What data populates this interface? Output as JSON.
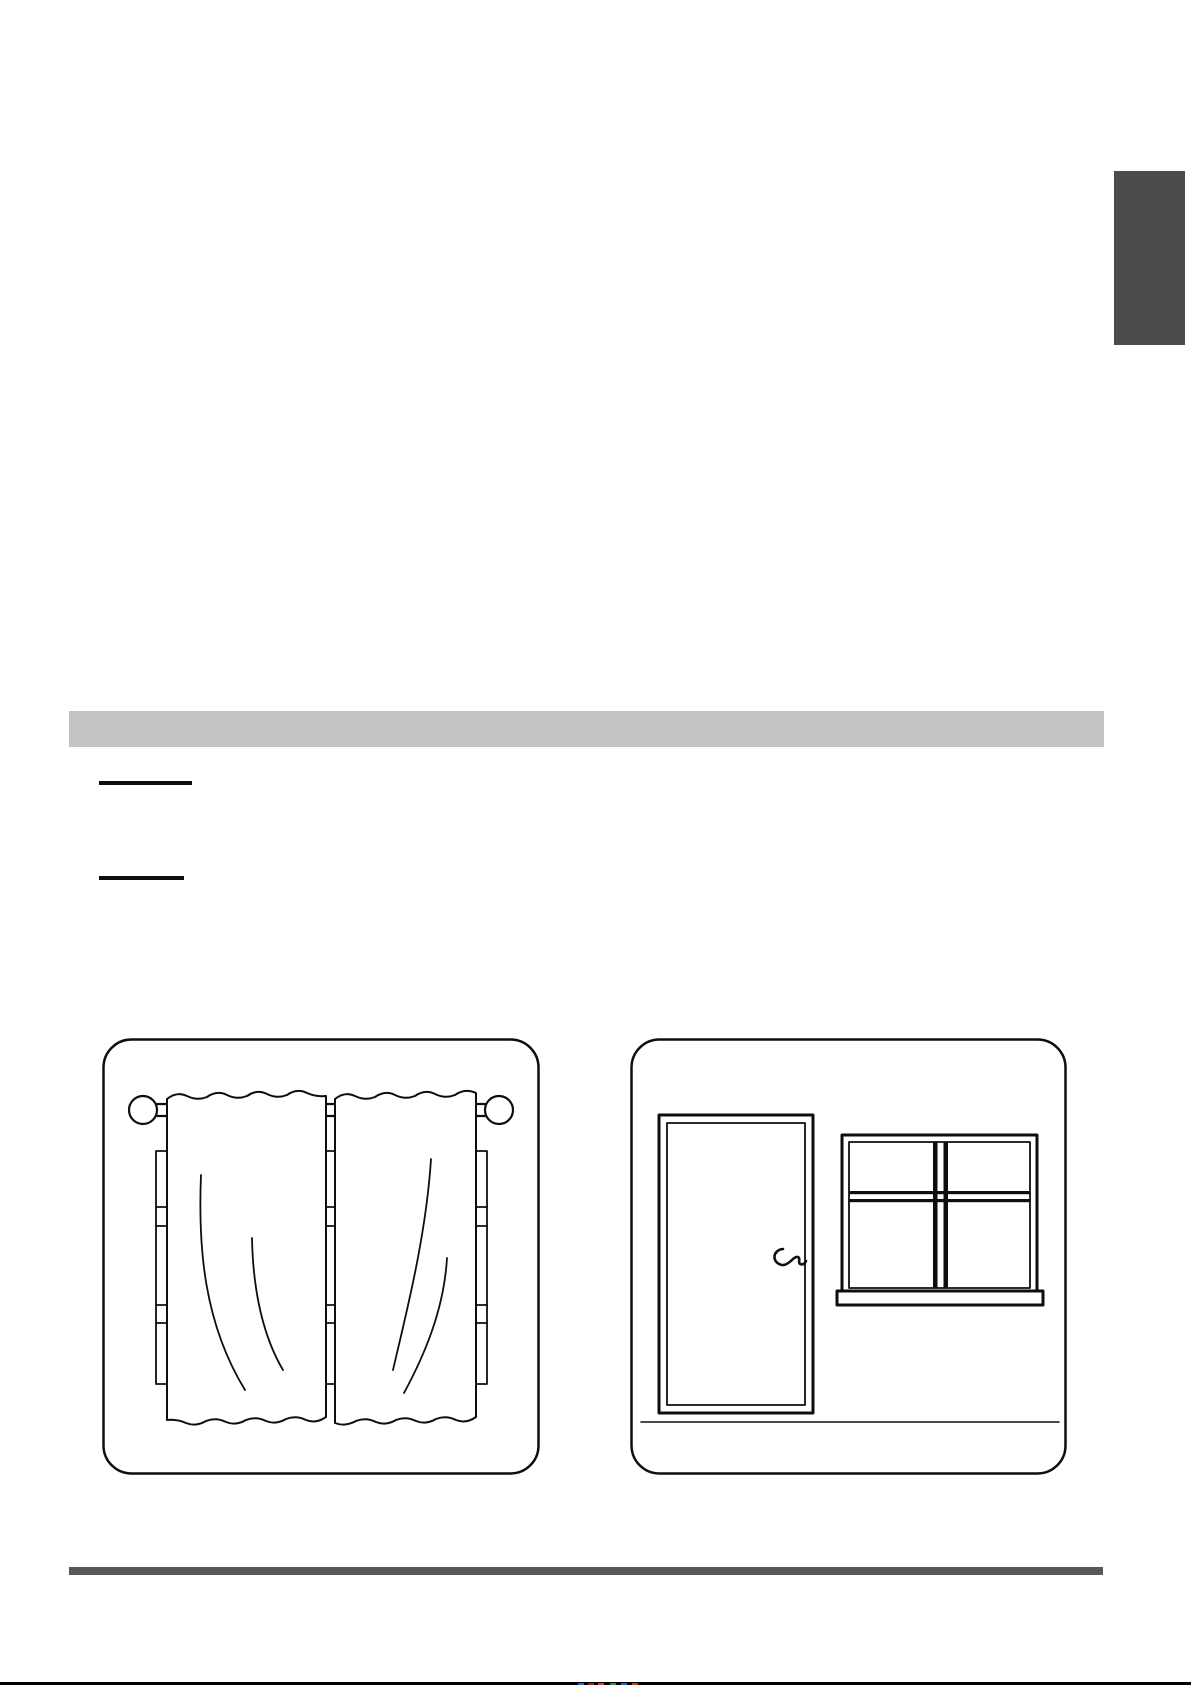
{
  "page": {
    "background_color": "#ffffff"
  },
  "chapter_tab": {
    "color": "#4a4b4d"
  },
  "section_divider_bar": {
    "color": "#c1c3c5"
  },
  "heading_underlines": {
    "color": "#0e0e0e",
    "count": 2
  },
  "footer_divider_bar": {
    "color": "#59595b"
  },
  "page_edge": {
    "line_color": "#000000",
    "print_mark_colors": [
      "#3f5bd6",
      "#a02020",
      "#d44027",
      "#1f8f4e",
      "#3350cc",
      "#cc3333"
    ]
  },
  "figures": [
    {
      "id": "curtains",
      "semantic": "closed-curtains-over-window-illustration"
    },
    {
      "id": "door-window",
      "semantic": "closed-door-and-closed-window-illustration"
    }
  ]
}
